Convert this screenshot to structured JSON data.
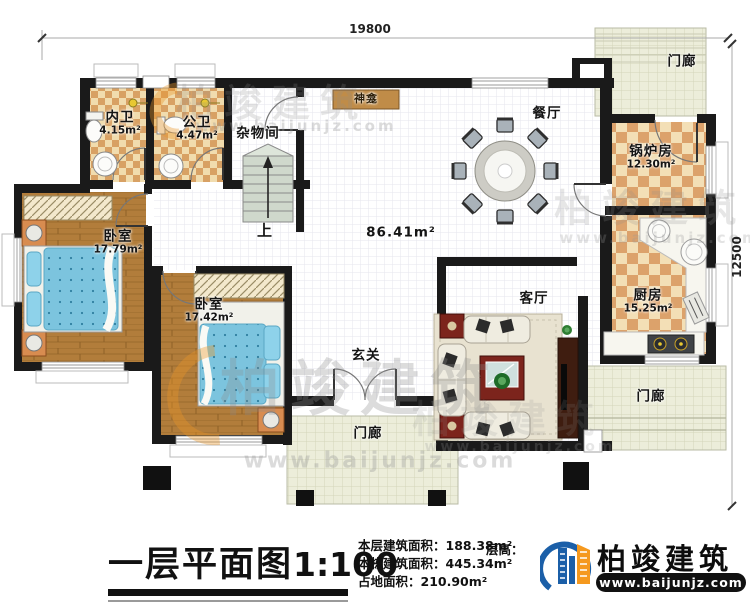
{
  "plan": {
    "dim_top": "19800",
    "dim_right": "12500",
    "rooms": {
      "neiwei": {
        "name": "内卫",
        "area": "4.15m²"
      },
      "gongwei": {
        "name": "公卫",
        "area": "4.47m²"
      },
      "zawujian": {
        "name": "杂物间"
      },
      "shenkan": {
        "name": "神龛"
      },
      "canting": {
        "name": "餐厅"
      },
      "guolufang": {
        "name": "锅炉房",
        "area": "12.30m²"
      },
      "porch_top": {
        "name": "门廊"
      },
      "bedroom1": {
        "name": "卧室",
        "area": "17.79m²"
      },
      "bedroom2": {
        "name": "卧室",
        "area": "17.42m²"
      },
      "stairs": {
        "name": "上"
      },
      "hall": {
        "area": "86.41m²"
      },
      "keting": {
        "name": "客厅"
      },
      "chufang": {
        "name": "厨房",
        "area": "15.25m²"
      },
      "xuanguan": {
        "name": "玄关"
      },
      "porch_bottom": {
        "name": "门廊"
      },
      "porch_right": {
        "name": "门廊"
      }
    }
  },
  "footer": {
    "title": "一层平面图",
    "scale": "1:100",
    "stats": [
      {
        "label": "本层建筑面积：",
        "value": "188.38m²"
      },
      {
        "label": "本栋建筑面积：",
        "value": "445.34m²"
      },
      {
        "label": "占地面积：",
        "value": "210.90m²"
      }
    ],
    "floor_height_label": "层高："
  },
  "branding": {
    "logo_text": "柏竣建筑",
    "logo_url": "www.baijunjz.com"
  },
  "watermark": {
    "text": "柏竣建筑",
    "url": "www.baijunjz.com"
  },
  "colors": {
    "wall": "#1a1a1a",
    "tile_light": "#f1dcae",
    "tile_dark": "#d8a164",
    "wood": "#b27d3b",
    "bed": "#7cc4de",
    "porch": "#ecedda",
    "logo_blue": "#1b5fa8",
    "logo_orange": "#f5991e"
  }
}
